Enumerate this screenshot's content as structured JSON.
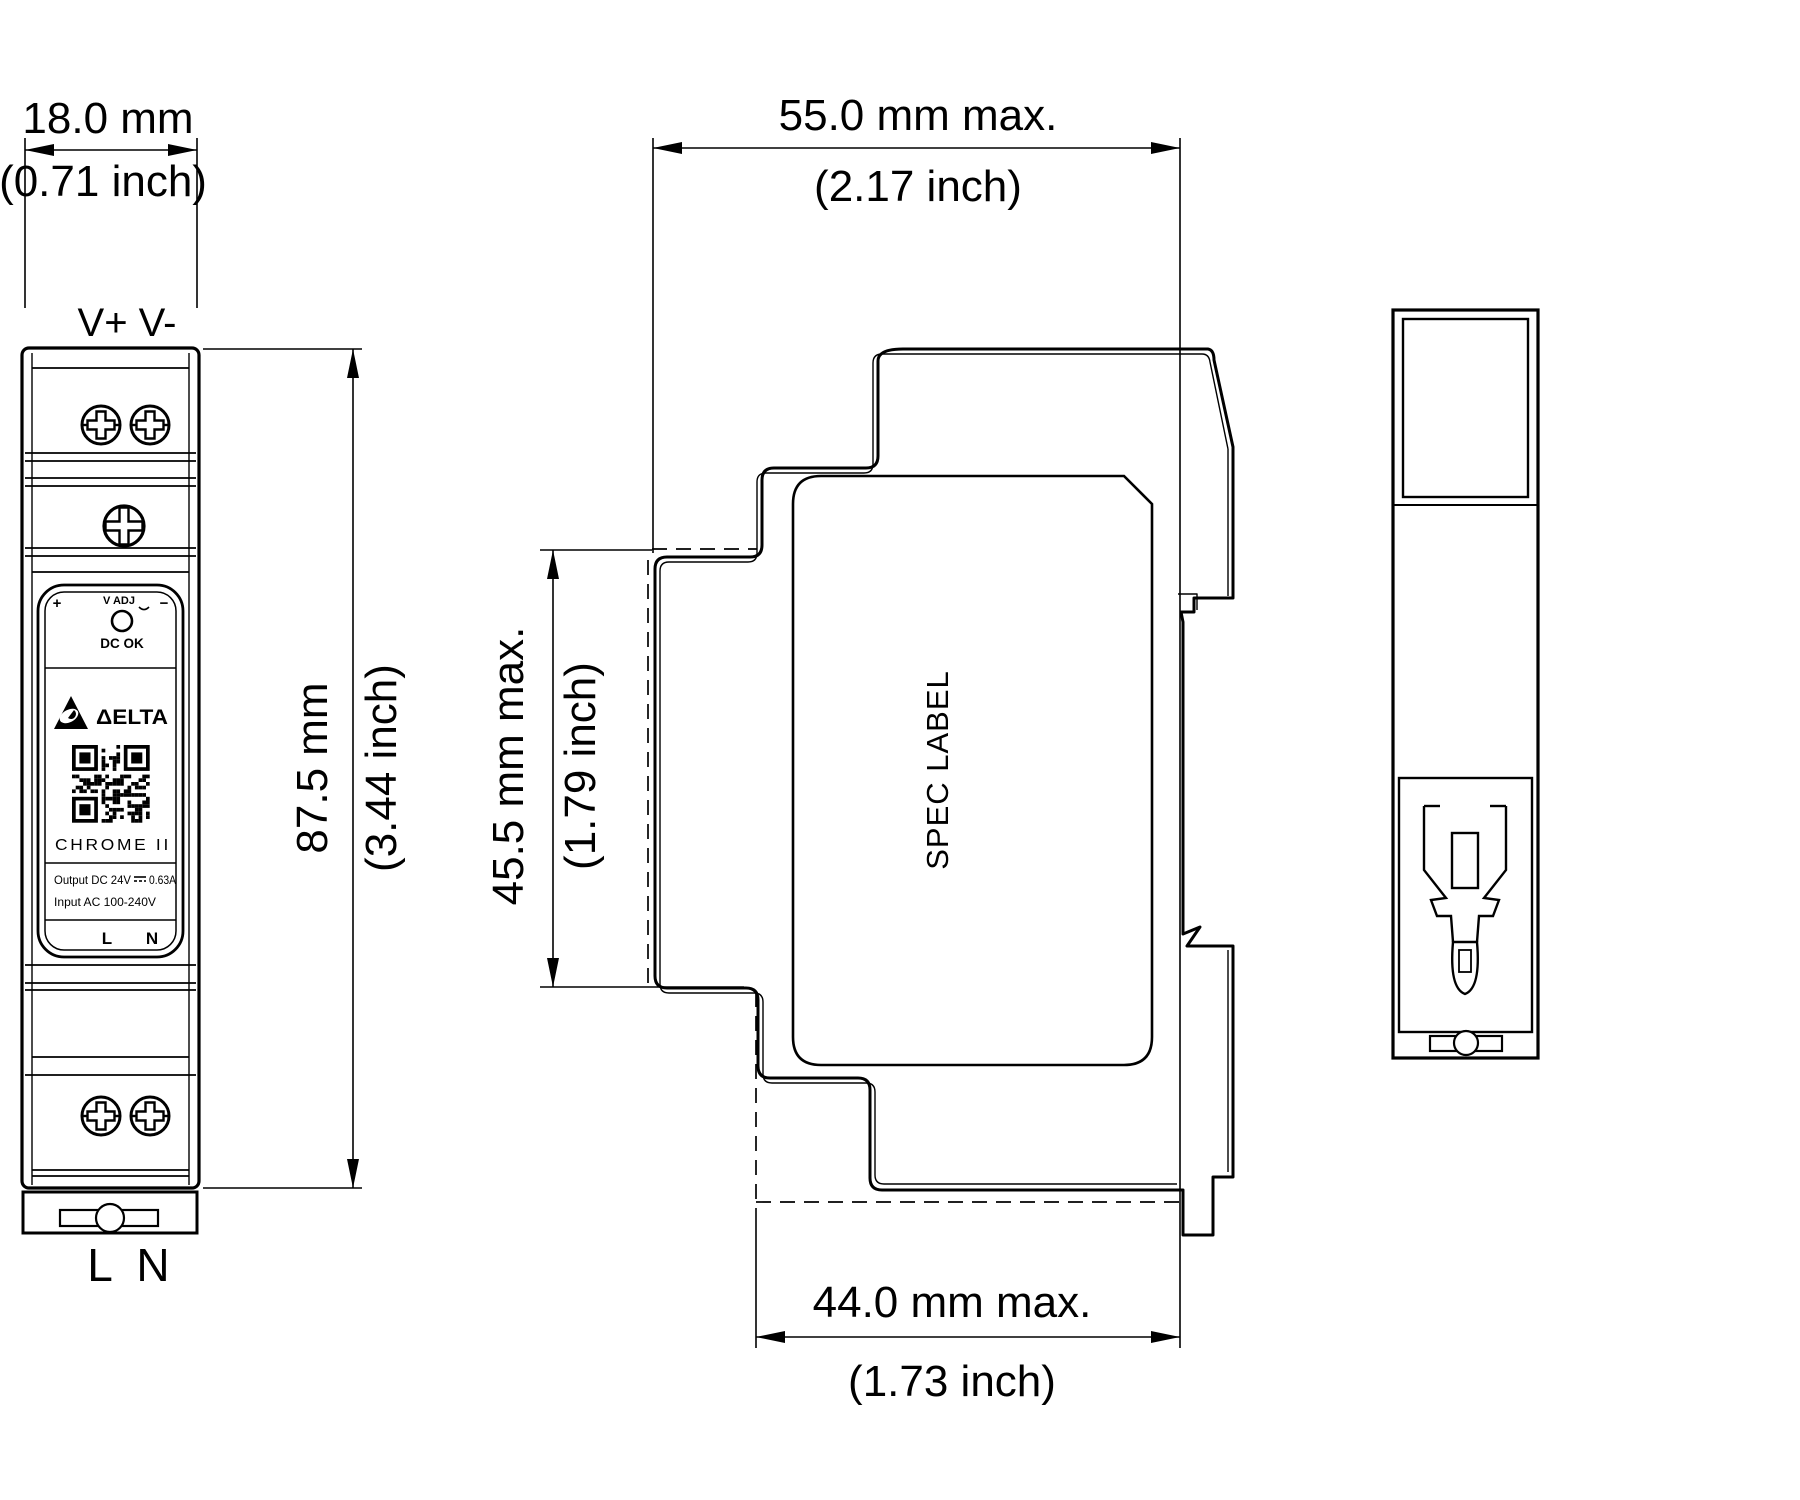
{
  "drawing": {
    "background": "#ffffff",
    "line_color": "#000000",
    "dimensions": {
      "width_front": {
        "value": "18.0 mm",
        "inch": "(0.71 inch)"
      },
      "depth_total": {
        "value": "55.0 mm max.",
        "inch": "(2.17 inch)"
      },
      "height_body": {
        "value": "87.5 mm",
        "inch": "(3.44 inch)"
      },
      "height_front_section": {
        "value": "45.5 mm max.",
        "inch": "(1.79 inch)"
      },
      "depth_behind_front": {
        "value": "44.0 mm max.",
        "inch": "(1.73 inch)"
      }
    },
    "front_view": {
      "output_terminals": "V+ V-",
      "plus": "+",
      "minus": "−",
      "v_adj": "V ADJ",
      "dc_ok": "DC OK",
      "brand": "ΔELTA",
      "model": "CHROME II",
      "output_rating": "Output DC 24V",
      "output_current": "0.63A",
      "input_rating": "Input AC 100-240V",
      "label_l": "L",
      "label_n": "N",
      "input_l": "L",
      "input_n": "N"
    },
    "side_view": {
      "spec_label": "SPEC LABEL"
    }
  }
}
